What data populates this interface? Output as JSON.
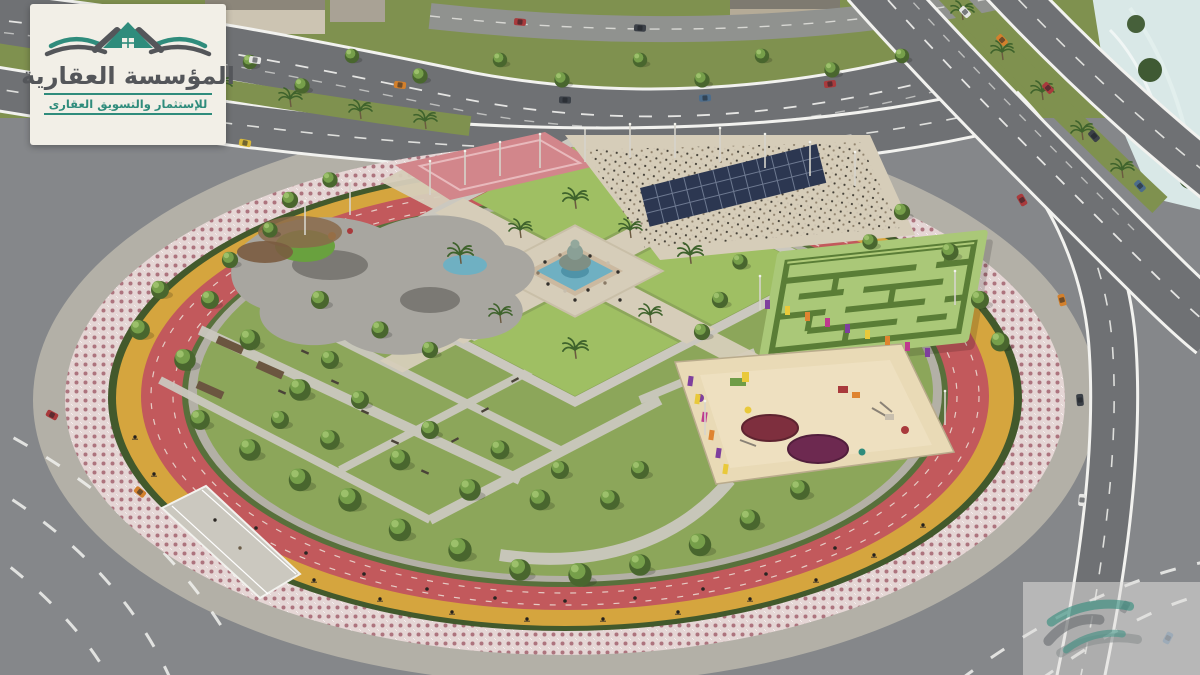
{
  "logo": {
    "title": "المؤسسة العقارية",
    "subtitle": "للإستثمار والتسويق العقارى",
    "mark": "twin-roof-house-with-waves-icon"
  },
  "watermark": {
    "mark": "twin-roof-house-3d-icon"
  },
  "scene": {
    "type": "aerial-architectural-render",
    "features": [
      "circular-park",
      "ornamental-mosaic-ring",
      "cycling-lane",
      "running-track",
      "central-fountain-plaza",
      "lawn-quadrants",
      "hedge-maze",
      "children-playground",
      "skate-park",
      "event-plaza-crowd",
      "solar-panel-canopy",
      "perimeter-highways",
      "palm-tree-medians",
      "pedestrian-bridge",
      "rock-water-feature",
      "street-cars",
      "park-trees",
      "light-masts"
    ]
  },
  "palette": {
    "card_bg": "#f2efe7",
    "teal": "#2f8c7c",
    "logo_text": "#54565a",
    "asphalt": "#85878a",
    "road": "#6f7174",
    "lane": "#f2f2ef",
    "concrete": "#b5b2a9",
    "paver": "#cbc8bf",
    "grass_outer": "#7f914f",
    "grass_park": "#8ca65a",
    "lawn": "#9fbf63",
    "tree_dark": "#49662e",
    "tree_light": "#79a24c",
    "palm": "#3f632c",
    "track": "#c2595c",
    "cycle": "#d5a53e",
    "mosaic": "#e5d6d5",
    "mosaic_dot": "#a4636e",
    "hedge": "#42592c",
    "maze_base": "#aac878",
    "maze_wall": "#5a7d36",
    "sand": "#e9dab6",
    "water": "#6fb0c2",
    "water_rock": "#d9e8e7",
    "plaza": "#d6cdb9",
    "solar": "#2c3751",
    "skate": "#a8a6a0",
    "skate_dark": "#7b7974",
    "skate_pink": "#d2868b",
    "fence_purple": "#7e3f9d",
    "fence_orange": "#df8430",
    "fence_yellow": "#e9c93a",
    "fence_magenta": "#bf3a8e",
    "car_red": "#a93a3c",
    "car_orange": "#d3802c",
    "car_blue": "#4c6d8c",
    "car_dark": "#3c4148",
    "car_white": "#e6e6e4",
    "car_yellow": "#d8b93a"
  }
}
